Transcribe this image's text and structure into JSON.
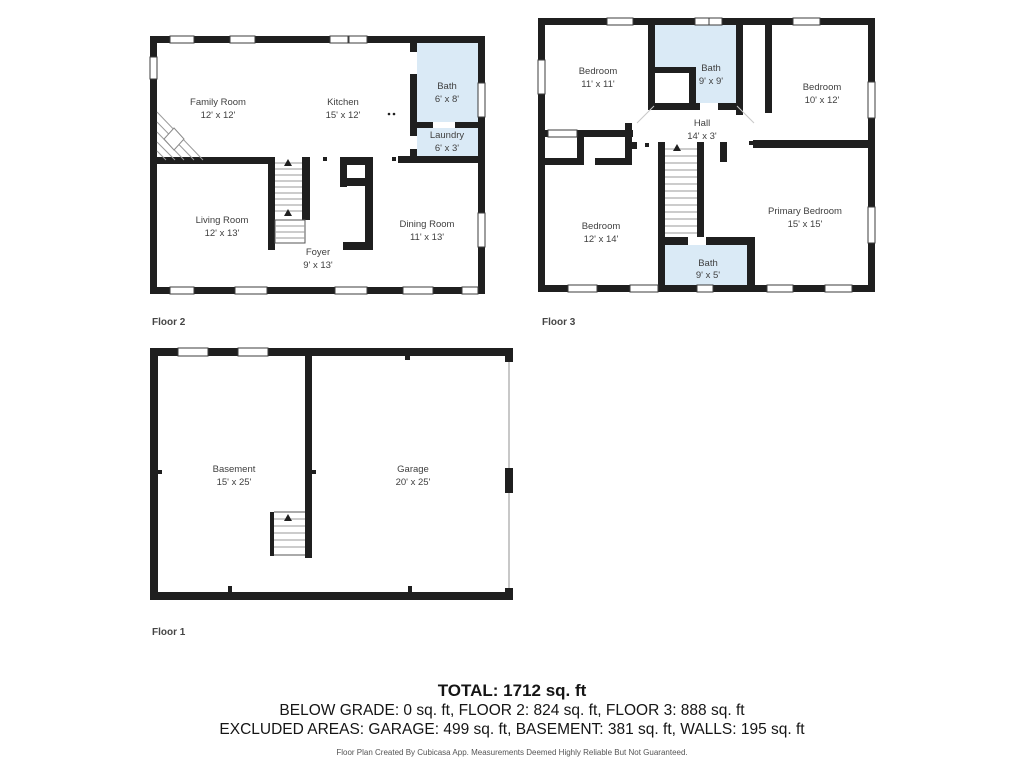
{
  "colors": {
    "wall": "#1f1f1f",
    "bath_fill": "#daeaf6",
    "background": "#ffffff"
  },
  "floors": [
    {
      "label": "Floor 2",
      "rooms": [
        {
          "name": "Family Room",
          "dims": "12' x 12'"
        },
        {
          "name": "Kitchen",
          "dims": "15' x 12'"
        },
        {
          "name": "Bath",
          "dims": "6' x 8'"
        },
        {
          "name": "Laundry",
          "dims": "6' x 3'"
        },
        {
          "name": "Living Room",
          "dims": "12' x 13'"
        },
        {
          "name": "Foyer",
          "dims": "9' x 13'"
        },
        {
          "name": "Dining Room",
          "dims": "11' x 13'"
        }
      ]
    },
    {
      "label": "Floor 3",
      "rooms": [
        {
          "name": "Bedroom",
          "dims": "11' x 11'"
        },
        {
          "name": "Bath",
          "dims": "9' x 9'"
        },
        {
          "name": "Bedroom",
          "dims": "10' x 12'"
        },
        {
          "name": "Hall",
          "dims": "14' x 3'"
        },
        {
          "name": "Bedroom",
          "dims": "12' x 14'"
        },
        {
          "name": "Primary Bedroom",
          "dims": "15' x 15'"
        },
        {
          "name": "Bath",
          "dims": "9' x 5'"
        }
      ]
    },
    {
      "label": "Floor 1",
      "rooms": [
        {
          "name": "Basement",
          "dims": "15' x 25'"
        },
        {
          "name": "Garage",
          "dims": "20' x 25'"
        }
      ]
    }
  ],
  "summary": {
    "total": "TOTAL: 1712 sq. ft",
    "line1": "BELOW GRADE: 0 sq. ft, FLOOR 2: 824 sq. ft, FLOOR 3: 888 sq. ft",
    "line2": "EXCLUDED AREAS: GARAGE: 499 sq. ft, BASEMENT: 381 sq. ft, WALLS: 195 sq. ft",
    "disclaimer": "Floor Plan Created By Cubicasa App. Measurements Deemed Highly Reliable But Not Guaranteed."
  }
}
